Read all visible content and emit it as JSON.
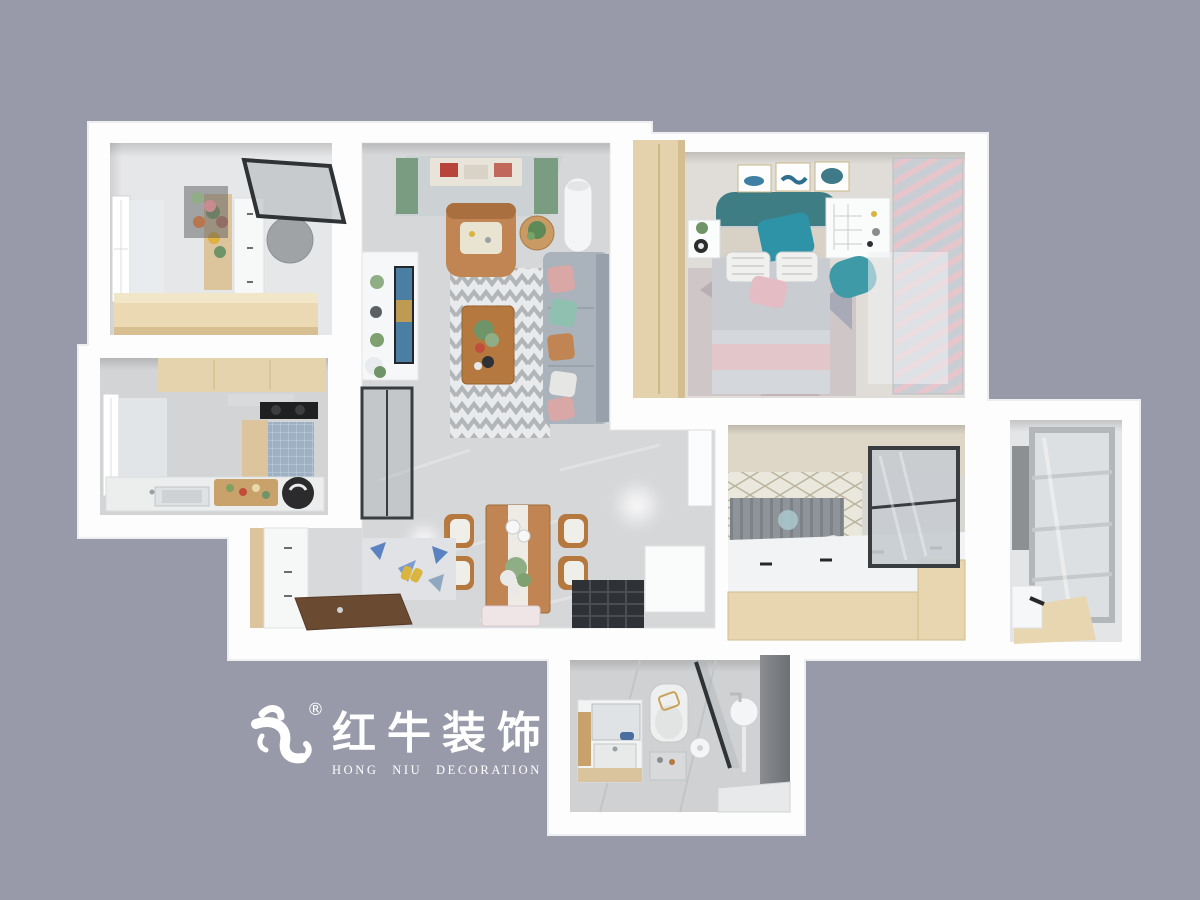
{
  "title": "3D top-down apartment floor plan render",
  "background_color": "#989aa9",
  "logo": {
    "registered_mark": "®",
    "brand_cn": "红牛装饰",
    "brand_en": "HONG NIU DECORATION",
    "color": "#ffffff"
  },
  "scene": {
    "view": "top-down 3d render",
    "rooms": [
      "study",
      "kitchen",
      "living-room",
      "dining-hall",
      "entry",
      "master-bedroom",
      "second-bedroom",
      "utility-balcony",
      "bathroom"
    ]
  },
  "palette": {
    "wall_white": "#ffffff",
    "floor_marble": "#d6d7d9",
    "wood_light": "#e5d3ae",
    "wood_mid": "#b5793f",
    "sofa_gray": "#aab3bc",
    "teal_accent": "#2f93a8",
    "pink_accent": "#e4bcc4",
    "curtain_green": "#7a9c80",
    "grate_dark": "#2e3135",
    "mosaic_blue": "#9db0c4"
  }
}
